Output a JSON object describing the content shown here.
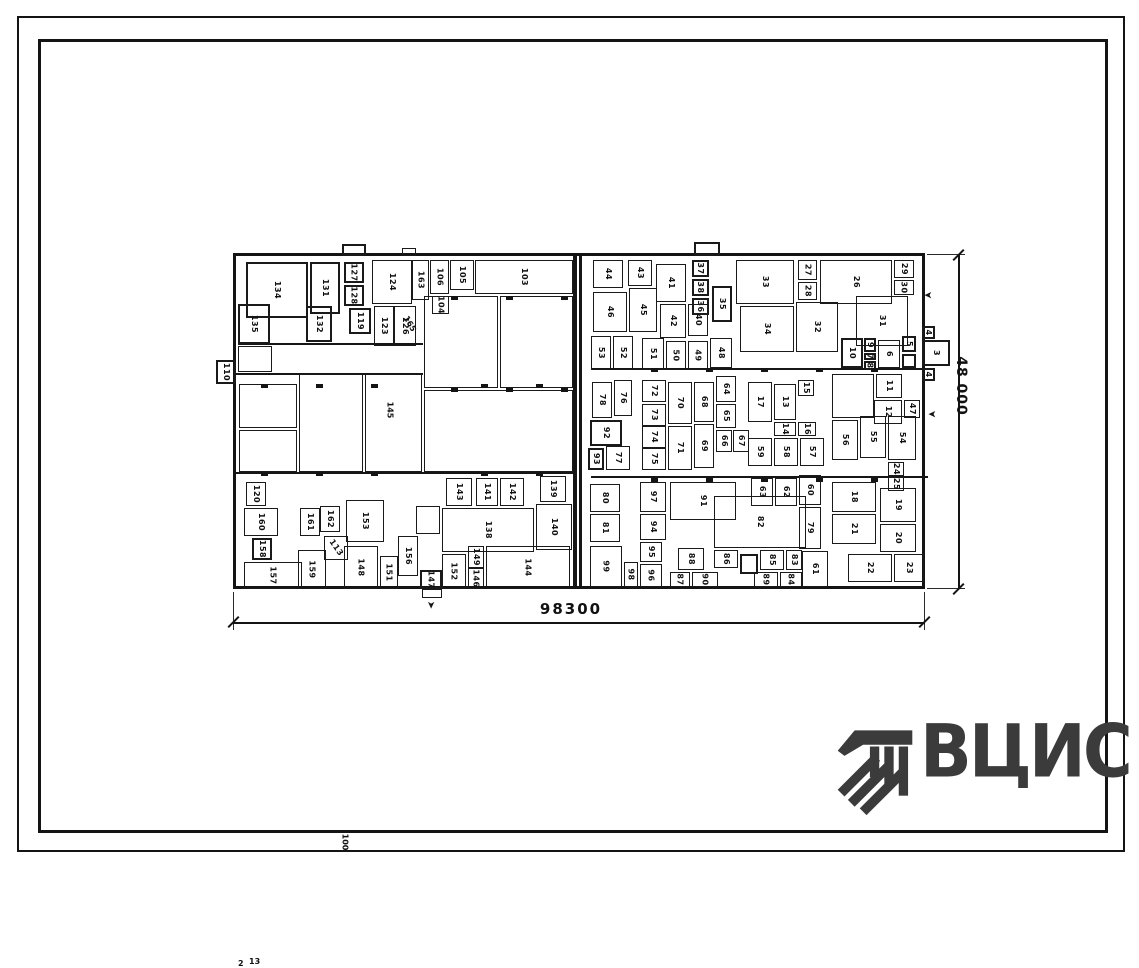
{
  "dimensions": {
    "width_label": "98300",
    "height_label": "48 000"
  },
  "logo": {
    "text": "ВЦИС",
    "color": "#3b3b3b"
  },
  "plan": {
    "rooms": [
      [
        "134",
        10,
        6,
        62,
        56,
        "t"
      ],
      [
        "131",
        74,
        6,
        30,
        52,
        "t"
      ],
      [
        "135",
        2,
        48,
        32,
        40,
        "t"
      ],
      [
        "132",
        70,
        50,
        26,
        36,
        "t"
      ],
      [
        "127",
        108,
        6,
        20,
        21,
        "t"
      ],
      [
        "128",
        108,
        29,
        20,
        21,
        "t"
      ],
      [
        "119",
        113,
        52,
        22,
        26,
        "t"
      ],
      [
        "124",
        136,
        4,
        40,
        44
      ],
      [
        "123",
        138,
        50,
        20,
        40
      ],
      [
        "126",
        158,
        50,
        22,
        40
      ],
      [
        "163",
        176,
        4,
        17,
        40
      ],
      [
        "106",
        194,
        4,
        19,
        34
      ],
      [
        "104",
        196,
        40,
        17,
        18
      ],
      [
        "105",
        214,
        4,
        24,
        30
      ],
      [
        "103",
        239,
        4,
        98,
        34
      ],
      [
        "110",
        -20,
        104,
        20,
        24,
        "t"
      ],
      [
        "",
        2,
        90,
        34,
        26
      ],
      [
        "",
        188,
        40,
        74,
        92
      ],
      [
        "",
        264,
        40,
        73,
        92
      ],
      [
        "",
        188,
        134,
        149,
        82
      ],
      [
        "",
        3,
        128,
        58,
        44
      ],
      [
        "",
        3,
        174,
        58,
        42
      ],
      [
        "",
        63,
        118,
        64,
        98
      ],
      [
        "",
        129,
        118,
        57,
        98
      ],
      [
        "120",
        10,
        226,
        20,
        24
      ],
      [
        "160",
        8,
        252,
        34,
        28
      ],
      [
        "158",
        16,
        282,
        20,
        22,
        "t"
      ],
      [
        "157",
        8,
        306,
        58,
        27
      ],
      [
        "161",
        64,
        252,
        20,
        28
      ],
      [
        "162",
        84,
        250,
        20,
        26
      ],
      [
        "113",
        88,
        280,
        24,
        24,
        "d"
      ],
      [
        "159",
        62,
        294,
        28,
        39
      ],
      [
        "153",
        110,
        244,
        38,
        42
      ],
      [
        "148",
        108,
        290,
        34,
        43
      ],
      [
        "151",
        144,
        300,
        18,
        33
      ],
      [
        "156",
        162,
        280,
        20,
        40
      ],
      [
        "147",
        184,
        314,
        22,
        19,
        "t"
      ],
      [
        "143",
        210,
        222,
        26,
        28
      ],
      [
        "141",
        240,
        222,
        22,
        28
      ],
      [
        "142",
        264,
        222,
        24,
        28
      ],
      [
        "139",
        304,
        220,
        26,
        26
      ],
      [
        "138",
        206,
        252,
        92,
        44
      ],
      [
        "140",
        300,
        248,
        36,
        46
      ],
      [
        "152",
        206,
        298,
        24,
        35
      ],
      [
        "149",
        232,
        290,
        16,
        22
      ],
      [
        "146",
        232,
        312,
        16,
        21
      ],
      [
        "144",
        250,
        290,
        84,
        43
      ],
      [
        "",
        180,
        250,
        24,
        28
      ],
      [
        "44",
        357,
        4,
        30,
        28
      ],
      [
        "43",
        392,
        4,
        24,
        26
      ],
      [
        "41",
        420,
        8,
        30,
        38
      ],
      [
        "37",
        456,
        4,
        17,
        17,
        "t"
      ],
      [
        "38",
        456,
        23,
        17,
        17,
        "t"
      ],
      [
        "36",
        456,
        42,
        17,
        17,
        "t"
      ],
      [
        "35",
        476,
        30,
        20,
        36,
        "t"
      ],
      [
        "33",
        500,
        4,
        58,
        44
      ],
      [
        "27",
        562,
        4,
        19,
        20
      ],
      [
        "28",
        562,
        26,
        19,
        18
      ],
      [
        "26",
        584,
        4,
        72,
        44
      ],
      [
        "29",
        658,
        4,
        20,
        18
      ],
      [
        "30",
        658,
        24,
        20,
        15
      ],
      [
        "46",
        357,
        36,
        34,
        40
      ],
      [
        "45",
        393,
        32,
        28,
        44
      ],
      [
        "42",
        424,
        48,
        26,
        34
      ],
      [
        "40",
        452,
        48,
        20,
        32
      ],
      [
        "34",
        504,
        50,
        54,
        46
      ],
      [
        "32",
        560,
        46,
        42,
        50
      ],
      [
        "31",
        620,
        40,
        52,
        50
      ],
      [
        "53",
        355,
        80,
        20,
        34
      ],
      [
        "52",
        377,
        80,
        20,
        34
      ],
      [
        "51",
        406,
        82,
        22,
        32
      ],
      [
        "50",
        430,
        85,
        20,
        29
      ],
      [
        "49",
        452,
        85,
        20,
        29
      ],
      [
        "48",
        474,
        82,
        22,
        30
      ],
      [
        "10",
        605,
        82,
        22,
        30,
        "t"
      ],
      [
        "9",
        628,
        82,
        12,
        14,
        "t"
      ],
      [
        "7",
        628,
        97,
        12,
        7,
        "t"
      ],
      [
        "8",
        628,
        105,
        12,
        9,
        "t"
      ],
      [
        "6",
        642,
        84,
        22,
        28
      ],
      [
        "5",
        666,
        80,
        14,
        16,
        "t"
      ],
      [
        "",
        666,
        98,
        14,
        14,
        "t"
      ],
      [
        "4",
        686,
        70,
        13,
        13,
        "t"
      ],
      [
        "3",
        686,
        84,
        28,
        26,
        "t"
      ],
      [
        "4",
        686,
        112,
        13,
        13,
        "t"
      ],
      [
        "78",
        356,
        126,
        20,
        36
      ],
      [
        "76",
        378,
        124,
        18,
        36
      ],
      [
        "92",
        354,
        164,
        32,
        26,
        "t"
      ],
      [
        "93",
        352,
        192,
        16,
        22,
        "t"
      ],
      [
        "77",
        370,
        190,
        24,
        24
      ],
      [
        "72",
        406,
        124,
        24,
        22
      ],
      [
        "73",
        406,
        148,
        24,
        22
      ],
      [
        "74",
        406,
        170,
        24,
        22
      ],
      [
        "75",
        406,
        192,
        24,
        22
      ],
      [
        "70",
        432,
        126,
        24,
        42
      ],
      [
        "71",
        432,
        170,
        24,
        44
      ],
      [
        "68",
        458,
        126,
        20,
        40
      ],
      [
        "69",
        458,
        168,
        20,
        44
      ],
      [
        "64",
        480,
        120,
        20,
        26
      ],
      [
        "65",
        480,
        148,
        20,
        24
      ],
      [
        "66",
        480,
        174,
        16,
        22
      ],
      [
        "67",
        497,
        174,
        16,
        22
      ],
      [
        "17",
        512,
        126,
        24,
        40
      ],
      [
        "13",
        538,
        128,
        22,
        36
      ],
      [
        "14",
        538,
        166,
        22,
        14
      ],
      [
        "15",
        562,
        124,
        16,
        16
      ],
      [
        "16",
        562,
        166,
        18,
        14
      ],
      [
        "59",
        512,
        182,
        24,
        28
      ],
      [
        "58",
        538,
        182,
        24,
        28
      ],
      [
        "57",
        564,
        182,
        24,
        28
      ],
      [
        "56",
        596,
        164,
        26,
        40
      ],
      [
        "55",
        624,
        160,
        26,
        42
      ],
      [
        "54",
        652,
        160,
        28,
        44
      ],
      [
        "11",
        640,
        118,
        26,
        24
      ],
      [
        "12",
        638,
        144,
        28,
        24
      ],
      [
        "47",
        668,
        144,
        16,
        18
      ],
      [
        "",
        596,
        118,
        42,
        44
      ],
      [
        "80",
        354,
        228,
        30,
        28
      ],
      [
        "81",
        354,
        258,
        30,
        28
      ],
      [
        "99",
        354,
        290,
        32,
        41
      ],
      [
        "98",
        388,
        306,
        14,
        25
      ],
      [
        "97",
        404,
        226,
        26,
        30
      ],
      [
        "94",
        404,
        258,
        26,
        26
      ],
      [
        "95",
        404,
        286,
        22,
        20
      ],
      [
        "96",
        404,
        308,
        22,
        23
      ],
      [
        "91",
        434,
        226,
        66,
        38
      ],
      [
        "82",
        478,
        240,
        92,
        52
      ],
      [
        "88",
        442,
        292,
        26,
        22
      ],
      [
        "87",
        434,
        316,
        20,
        15
      ],
      [
        "90",
        456,
        316,
        26,
        15
      ],
      [
        "86",
        478,
        294,
        24,
        18
      ],
      [
        "",
        504,
        298,
        18,
        20,
        "t"
      ],
      [
        "85",
        524,
        294,
        24,
        20
      ],
      [
        "89",
        518,
        316,
        24,
        15
      ],
      [
        "83",
        550,
        294,
        16,
        20
      ],
      [
        "84",
        544,
        316,
        22,
        15
      ],
      [
        "61",
        566,
        295,
        26,
        36
      ],
      [
        "63",
        515,
        222,
        22,
        28
      ],
      [
        "62",
        539,
        222,
        22,
        28
      ],
      [
        "60",
        563,
        219,
        22,
        30
      ],
      [
        "79",
        563,
        251,
        22,
        42
      ],
      [
        "18",
        596,
        226,
        44,
        30
      ],
      [
        "21",
        596,
        258,
        44,
        30
      ],
      [
        "19",
        644,
        232,
        36,
        34
      ],
      [
        "20",
        644,
        268,
        36,
        28
      ],
      [
        "24",
        652,
        206,
        16,
        14
      ],
      [
        "25",
        652,
        221,
        16,
        14
      ],
      [
        "22",
        612,
        298,
        44,
        28
      ],
      [
        "23",
        658,
        298,
        30,
        28
      ],
      [
        "",
        106,
        -12,
        24,
        12,
        "t"
      ],
      [
        "",
        166,
        -8,
        14,
        8
      ],
      [
        "",
        458,
        -14,
        26,
        14,
        "t"
      ],
      [
        "",
        186,
        333,
        20,
        9
      ]
    ],
    "labels": [
      [
        "165",
        64,
        116,
        60
      ],
      [
        "145",
        150,
        248,
        90
      ],
      [
        "100",
        582,
        208,
        90
      ],
      [
        "13",
        702,
        32,
        0
      ],
      [
        "2",
        704,
        150,
        0
      ]
    ],
    "arrows": [
      [
        688,
        33,
        180
      ],
      [
        692,
        152,
        180
      ],
      [
        190,
        344,
        90
      ]
    ],
    "walls": [
      [
        337,
        0,
        4,
        330
      ],
      [
        343,
        0,
        3,
        330
      ],
      [
        0,
        117,
        187,
        2
      ],
      [
        0,
        216,
        337,
        2
      ],
      [
        355,
        112,
        337,
        2
      ],
      [
        355,
        220,
        337,
        2
      ],
      [
        2,
        87,
        185,
        2
      ]
    ],
    "columns": [
      [
        25,
        128
      ],
      [
        80,
        128
      ],
      [
        135,
        128
      ],
      [
        245,
        128
      ],
      [
        300,
        128
      ],
      [
        25,
        216
      ],
      [
        80,
        216
      ],
      [
        135,
        216
      ],
      [
        245,
        216
      ],
      [
        300,
        216
      ],
      [
        415,
        112
      ],
      [
        470,
        112
      ],
      [
        525,
        112
      ],
      [
        580,
        112
      ],
      [
        635,
        112
      ],
      [
        415,
        222
      ],
      [
        470,
        222
      ],
      [
        525,
        222
      ],
      [
        580,
        222
      ],
      [
        635,
        222
      ],
      [
        215,
        132
      ],
      [
        270,
        132
      ],
      [
        325,
        132
      ],
      [
        215,
        40
      ],
      [
        270,
        40
      ],
      [
        325,
        40
      ]
    ]
  }
}
